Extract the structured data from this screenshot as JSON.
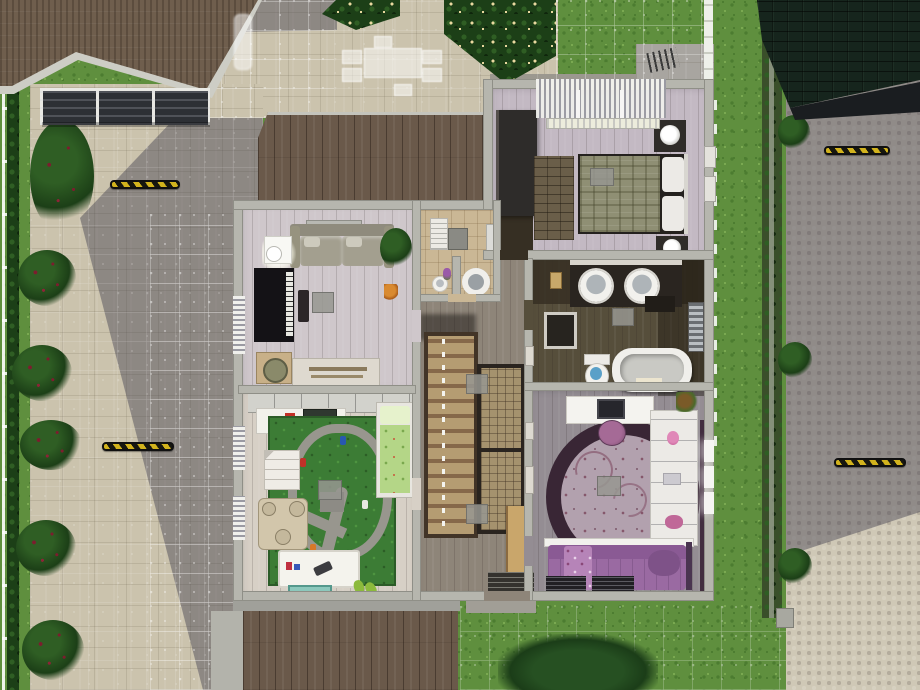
{
  "scene": {
    "description": "overhead dollhouse build-mode view of a suburban house upper floor with build grid",
    "rooms": {
      "master": {
        "label": "master bedroom",
        "furniture": [
          "double-bed-plaid-blanket",
          "nightstand-lamp x2",
          "dark-wardrobe",
          "brick-pattern-rug",
          "window-blinds",
          "radiator",
          "wall-frames",
          "ceiling-light"
        ]
      },
      "bathroom": {
        "label": "bathroom",
        "furniture": [
          "double-round-sinks",
          "bathtub",
          "toilet",
          "shower-hamper",
          "towel-radiator",
          "wall-cabinet",
          "ceiling-light"
        ]
      },
      "teen": {
        "label": "teen bedroom",
        "furniture": [
          "round-floral-rug",
          "purple-bed",
          "desk-computer",
          "vanity-stool",
          "white-dressers",
          "window x3",
          "slatted-benches",
          "ceiling-light"
        ]
      },
      "living": {
        "label": "upstairs living room",
        "furniture": [
          "sofa",
          "wall-shelf",
          "floor-lamp",
          "potted-plant",
          "piano",
          "piano-bench",
          "sideboard",
          "basket-table",
          "pet-toy",
          "ceiling-light"
        ]
      },
      "kids": {
        "label": "kids playroom",
        "furniture": [
          "road-playmat",
          "toy-cars",
          "green-bed",
          "dollhouse",
          "toy-castle",
          "desk-laptop",
          "green-chair",
          "toybox",
          "teal-mat",
          "slippers",
          "closet",
          "window-blinds x2"
        ]
      },
      "wc": {
        "label": "toilet room",
        "furniture": [
          "round-toilet",
          "pedestal-sink",
          "wall-cabinet",
          "radiator",
          "flower-vase"
        ]
      },
      "hall": {
        "label": "stair hall",
        "furniture": [
          "staircase",
          "runner-rug x2",
          "console-table",
          "doormat",
          "ceiling-light x2",
          "wall-frames"
        ]
      }
    },
    "exterior": {
      "left": [
        "white-fence",
        "hedgerow",
        "rose-bushes",
        "paver-driveway",
        "shadow"
      ],
      "top": [
        "brown-roof",
        "carport-pergola",
        "paver-patio",
        "flower-hedges",
        "ghost-outdoor-dining-set"
      ],
      "right": [
        "grass-strip",
        "white-fence",
        "hedge-wall",
        "cobblestone-road",
        "neighbor-dark-roof"
      ],
      "bottom": [
        "lower-roof-planks",
        "grass",
        "large-bush",
        "entry-stoop"
      ],
      "markers": [
        "hazard-stripe-curb-marker x4"
      ],
      "grid": "white build grid on driveway, patio and grass"
    }
  },
  "colors": {
    "grass1": "#5f8f3e",
    "grass2": "#4c7c30",
    "grass3": "#7cab52",
    "hedge1": "#1c3f17",
    "hedge2": "#2f5e24",
    "flowerCream": "#ead9a0",
    "flowerRed": "#7c1d2e",
    "paver": "#cbc3ad",
    "shadowTint": "rgba(66,64,80,0.45)",
    "cobble": "#cfc8b6",
    "roofBrown": "#6f5e4d",
    "roofPlank": "#6a594a",
    "roofDark": "#16251d",
    "carport": "#2d3035",
    "beam": "#e9e9e4",
    "wall": "#b6b6ae",
    "wallEdge": "#8f8f87",
    "floorLiving": "#cfc7cb",
    "floorMaster": "#c3b9c3",
    "floorKids": "#d7d0c6",
    "floorTeen": "#948d93",
    "floorHall": "#8e8579",
    "floorWC": "#cab795",
    "floorBath": "#564e3b",
    "floorBathDark": "#362f23",
    "plum": "#422e3f",
    "rugPlum": "#392635",
    "rugPlumIn": "#b2a1ae",
    "bedPurple": "#9a6aa2",
    "stairWood": "#b59c72",
    "stairDark": "#423427",
    "gridWhite": "rgba(255,255,255,0.55)",
    "markerY": "#d2b31d",
    "markerK": "#17170f",
    "white": "#f1f0ec"
  }
}
